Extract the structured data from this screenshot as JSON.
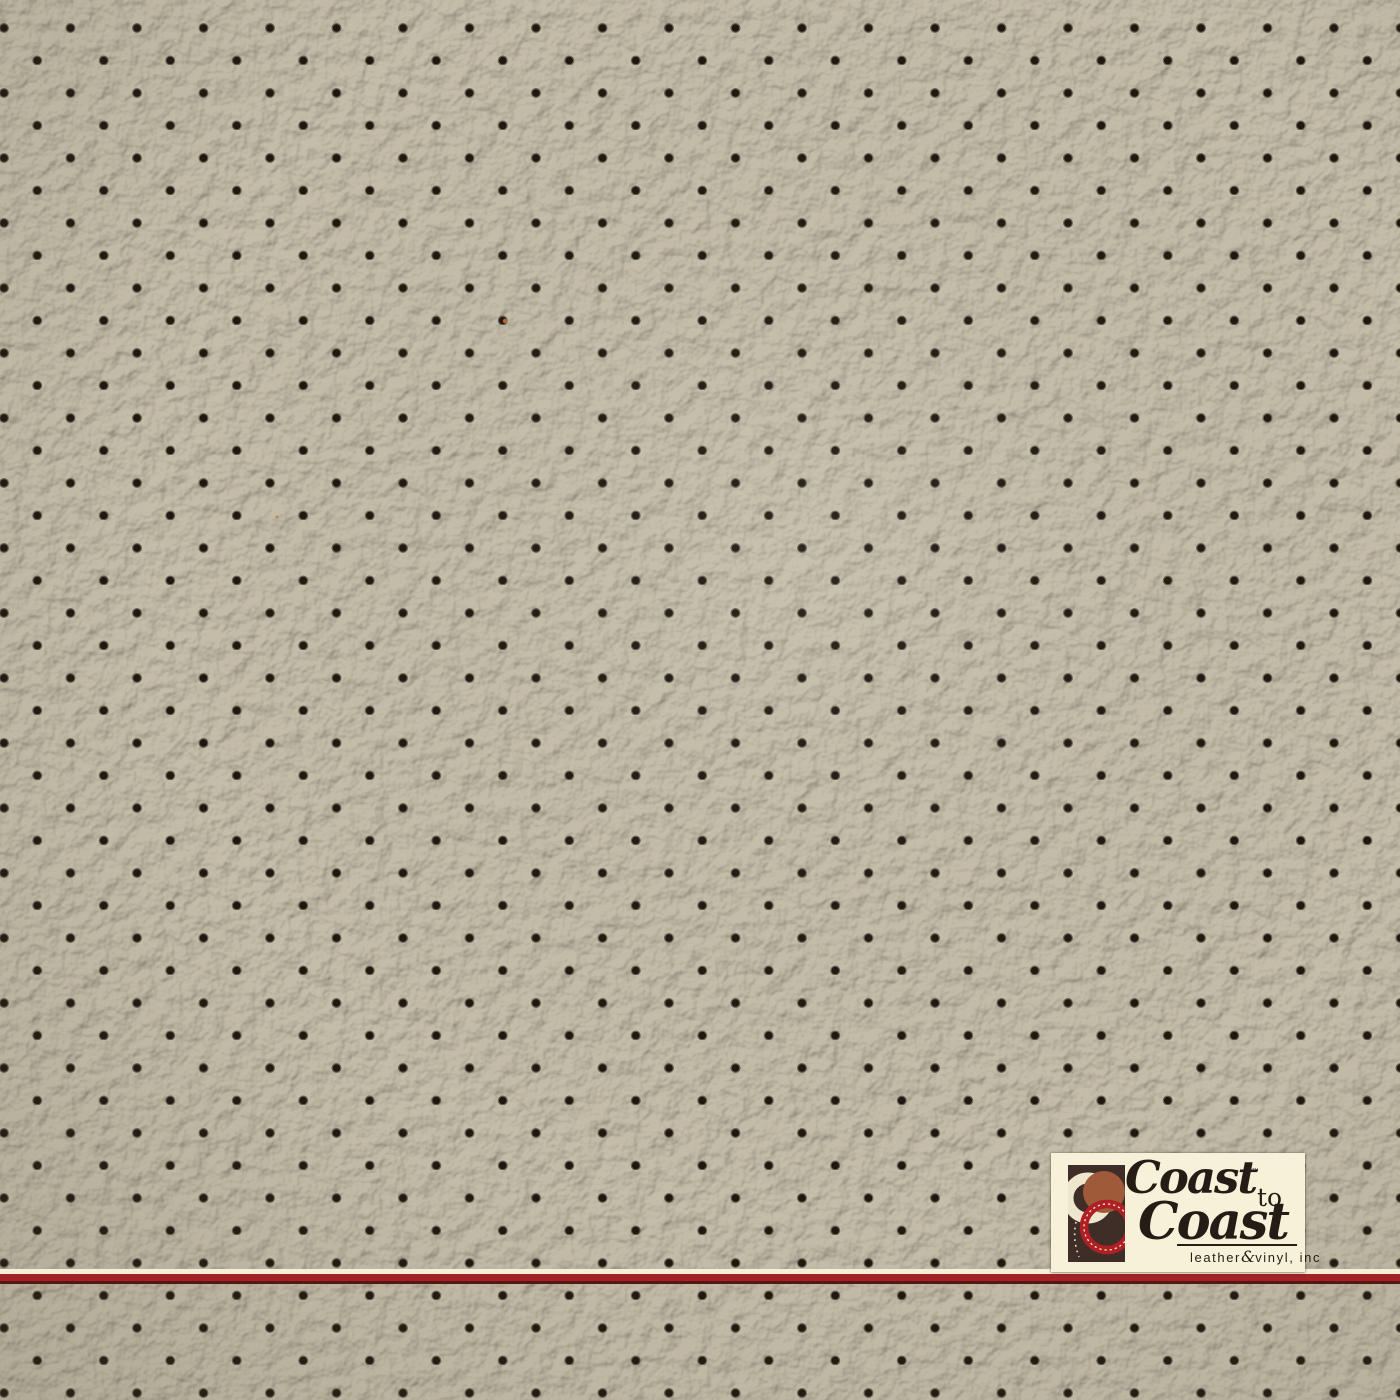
{
  "photo": {
    "subject": "Close-up swatch of beige perforated pebble-grain leather vinyl"
  },
  "swatch": {
    "base_color": "#c4bda9",
    "highlight_color": "#dad5c3",
    "shadow_color": "#8f8873",
    "perforation_color": "#1d1710",
    "perforation_rim_color": "#4e4736",
    "speck_color": "#c8702f"
  },
  "divider": {
    "cream_color": "#f6efd7",
    "red_color": "#a32127",
    "dark_red_color": "#541712"
  },
  "watermark": {
    "bg_color": "#f8f1da",
    "text_color": "#241d15",
    "word_top": "Coast",
    "trademark": "™",
    "connector": "to",
    "word_bottom": "Coast",
    "tagline_word1": "leather",
    "tagline_amp": "&",
    "tagline_word2": "vinyl, inc",
    "mark": {
      "panel_color": "#3f2e28",
      "cream_color": "#efe7cd",
      "sienna_color": "#9e5a39",
      "ring_color": "#b01f24",
      "stitch_color": "#f3ecd6"
    }
  }
}
